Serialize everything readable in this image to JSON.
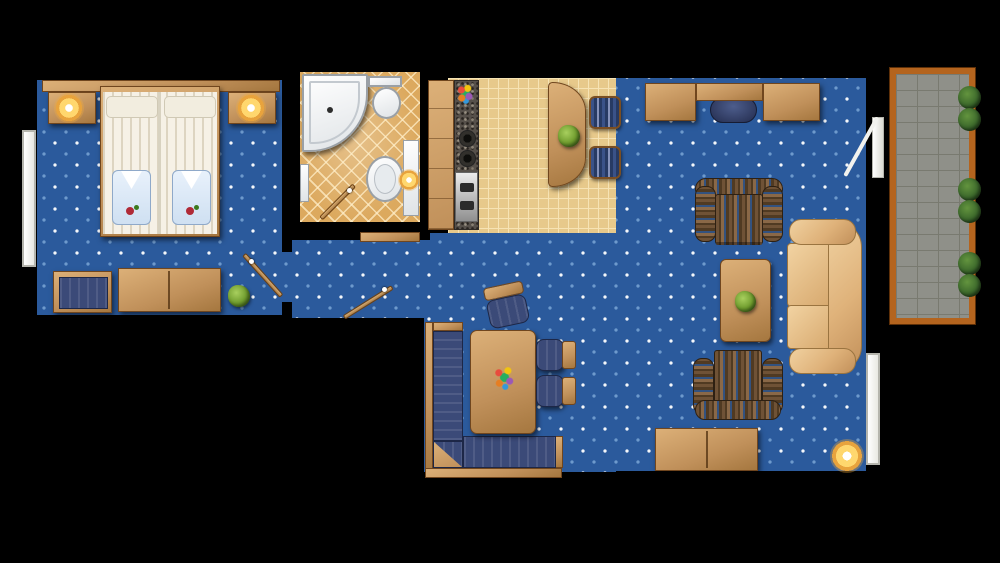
{
  "title": "suite-floor-plan",
  "palette": {
    "wall": "#000000",
    "carpet": "#2b5a9c",
    "wood": "#c0905a",
    "wood-hi": "#dcb078",
    "wood-edge": "#70461e",
    "bath-tile": "#dca95e",
    "kitchen-tile": "#e7c98b",
    "kitchen-line": "#f6e3b4",
    "granite": "#56504a",
    "fixture": "#f6f6f2",
    "fixture-edge": "#9aa0a6",
    "navy": "#3b4a78",
    "navy-dark": "#232c4e",
    "beige": "#dfb27a",
    "beige-hi": "#f0d1a0",
    "beige-edge": "#9a7440",
    "balcony-tile": "#8f9089",
    "balcony-line": "#797a70",
    "balcony-frame": "#b4641e",
    "plant": "#6d9a2c",
    "shrub": "#39652a",
    "glow": "#ffd76e",
    "glow-ring": "#e8a33d",
    "robe": "#cfe0f2"
  },
  "rooms": [
    {
      "name": "bedroom",
      "floor": "blue-dotted-carpet",
      "furniture": [
        "twin-bed-left",
        "twin-bed-right",
        "nightstand-left",
        "nightstand-right",
        "bedside-lamp-left",
        "bedside-lamp-right",
        "folded-robe-left",
        "folded-robe-right",
        "luggage-bench",
        "dresser",
        "potted-plant",
        "window",
        "door"
      ]
    },
    {
      "name": "bathroom",
      "floor": "terracotta-diamond-tile",
      "furniture": [
        "corner-bathtub",
        "toilet",
        "washbasin",
        "vanity-counter",
        "vanity-lamp",
        "wall-shelf",
        "door"
      ]
    },
    {
      "name": "kitchen",
      "floor": "ceramic-grid-tile",
      "furniture": [
        "cabinet-run",
        "granite-counter",
        "stove-burners",
        "oven",
        "flower-vase",
        "curved-breakfast-bar",
        "bar-plant",
        "bar-stool-1",
        "bar-stool-2"
      ]
    },
    {
      "name": "living-room",
      "floor": "blue-dotted-carpet",
      "furniture": [
        "desk-left",
        "desk-shelf",
        "desk-right",
        "desk-chair",
        "armchair-north",
        "armchair-south",
        "coffee-table",
        "coffee-table-plant",
        "sofa",
        "sideboard",
        "floor-lamp",
        "window",
        "balcony-door"
      ]
    },
    {
      "name": "dining-area",
      "floor": "blue-dotted-carpet",
      "furniture": [
        "corner-bench",
        "dining-table",
        "flower-centerpiece",
        "dining-chair-top",
        "dining-chair-right-1",
        "dining-chair-right-2"
      ]
    },
    {
      "name": "hallway",
      "floor": "blue-dotted-carpet",
      "furniture": [
        "entry-door"
      ]
    },
    {
      "name": "balcony",
      "floor": "stone-grid-tile",
      "furniture": [
        "shrub-1",
        "shrub-2",
        "shrub-3",
        "shrub-4",
        "shrub-5",
        "shrub-6"
      ]
    }
  ],
  "counts": {
    "beds": 2,
    "bedside_lamps": 2,
    "bar_stools": 2,
    "armchairs": 2,
    "dining_chairs": 3,
    "corner_benches": 1,
    "sofas": 1,
    "potted_plants": 4,
    "shrubs": 6,
    "windows": 2,
    "interior_doors": 2,
    "entry_doors": 1,
    "balcony_doors": 1,
    "floor_lamps": 1,
    "vanity_lamps": 1
  }
}
